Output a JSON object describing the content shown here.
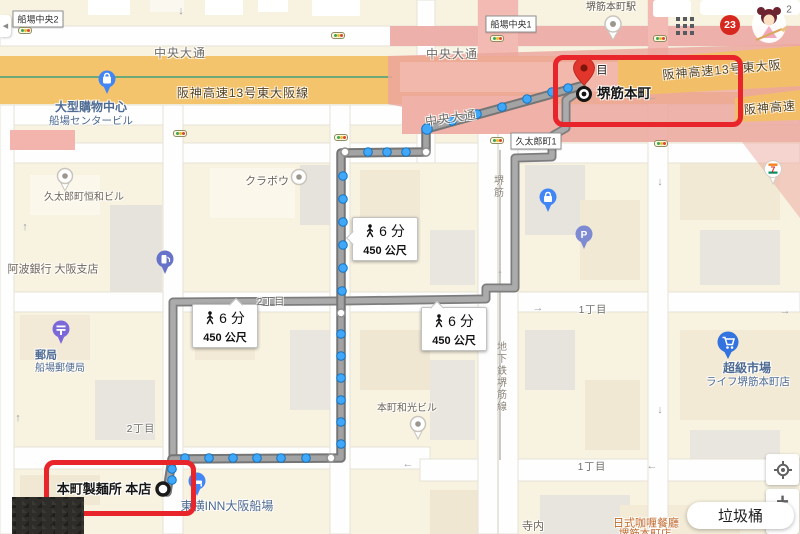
{
  "signs": {
    "semba_chuo_2": "船場中央2",
    "semba_chuo_1": "船場中央1",
    "kyutaro_machi_1": "久太郎町1"
  },
  "roads": {
    "chuo_odori": "中央大通",
    "hanshin_full": "阪神高速13号東大阪線",
    "hanshin_right": "阪神高速13号東大阪",
    "hanshin_short": "阪神高速",
    "sakaisuji": "堺筋",
    "subway_line": "地下鉄堺筋線",
    "chome_1": "1丁目",
    "chome_2": "2丁目"
  },
  "pois": {
    "station_name": "堺筋本町駅",
    "shopping1": "大型購物中心",
    "shopping2": "船場センタービル",
    "kurabo": "クラボウ",
    "kowa_bldg": "久太郎町恒和ビル",
    "awa_bank": "阿波銀行 大阪支店",
    "post1": "郵局",
    "post2": "船場郵便局",
    "wako_bldg": "本町和光ビル",
    "toyoko_inn": "東横INN大阪船場",
    "super1": "超級市場",
    "super2": "ライフ堺筋本町店",
    "terauchi": "寺内",
    "curry1": "日式咖喱餐廳",
    "curry2": "堺筋本町店"
  },
  "route": {
    "badge_time": "6 分",
    "badge_dist": "450 公尺",
    "origin_label": "本町製麺所 本店",
    "dest_flag": "目",
    "dest_name": "堺筋本町"
  },
  "overlay": {
    "count_badge": "23",
    "avatar_num": "2",
    "tooltip": "垃圾桶",
    "zoom_in": "+",
    "collapse_arrow": "◀"
  },
  "arrows": {
    "up": "↑",
    "down": "↓",
    "left": "←",
    "right": "→"
  },
  "colors": {
    "annotation_red": "#e8252a",
    "route_dot_blue": "#41a7f8",
    "highway_orange": "#f4c46d",
    "station_pink": "#eba79e",
    "route_gray": "#8f8f8f"
  }
}
